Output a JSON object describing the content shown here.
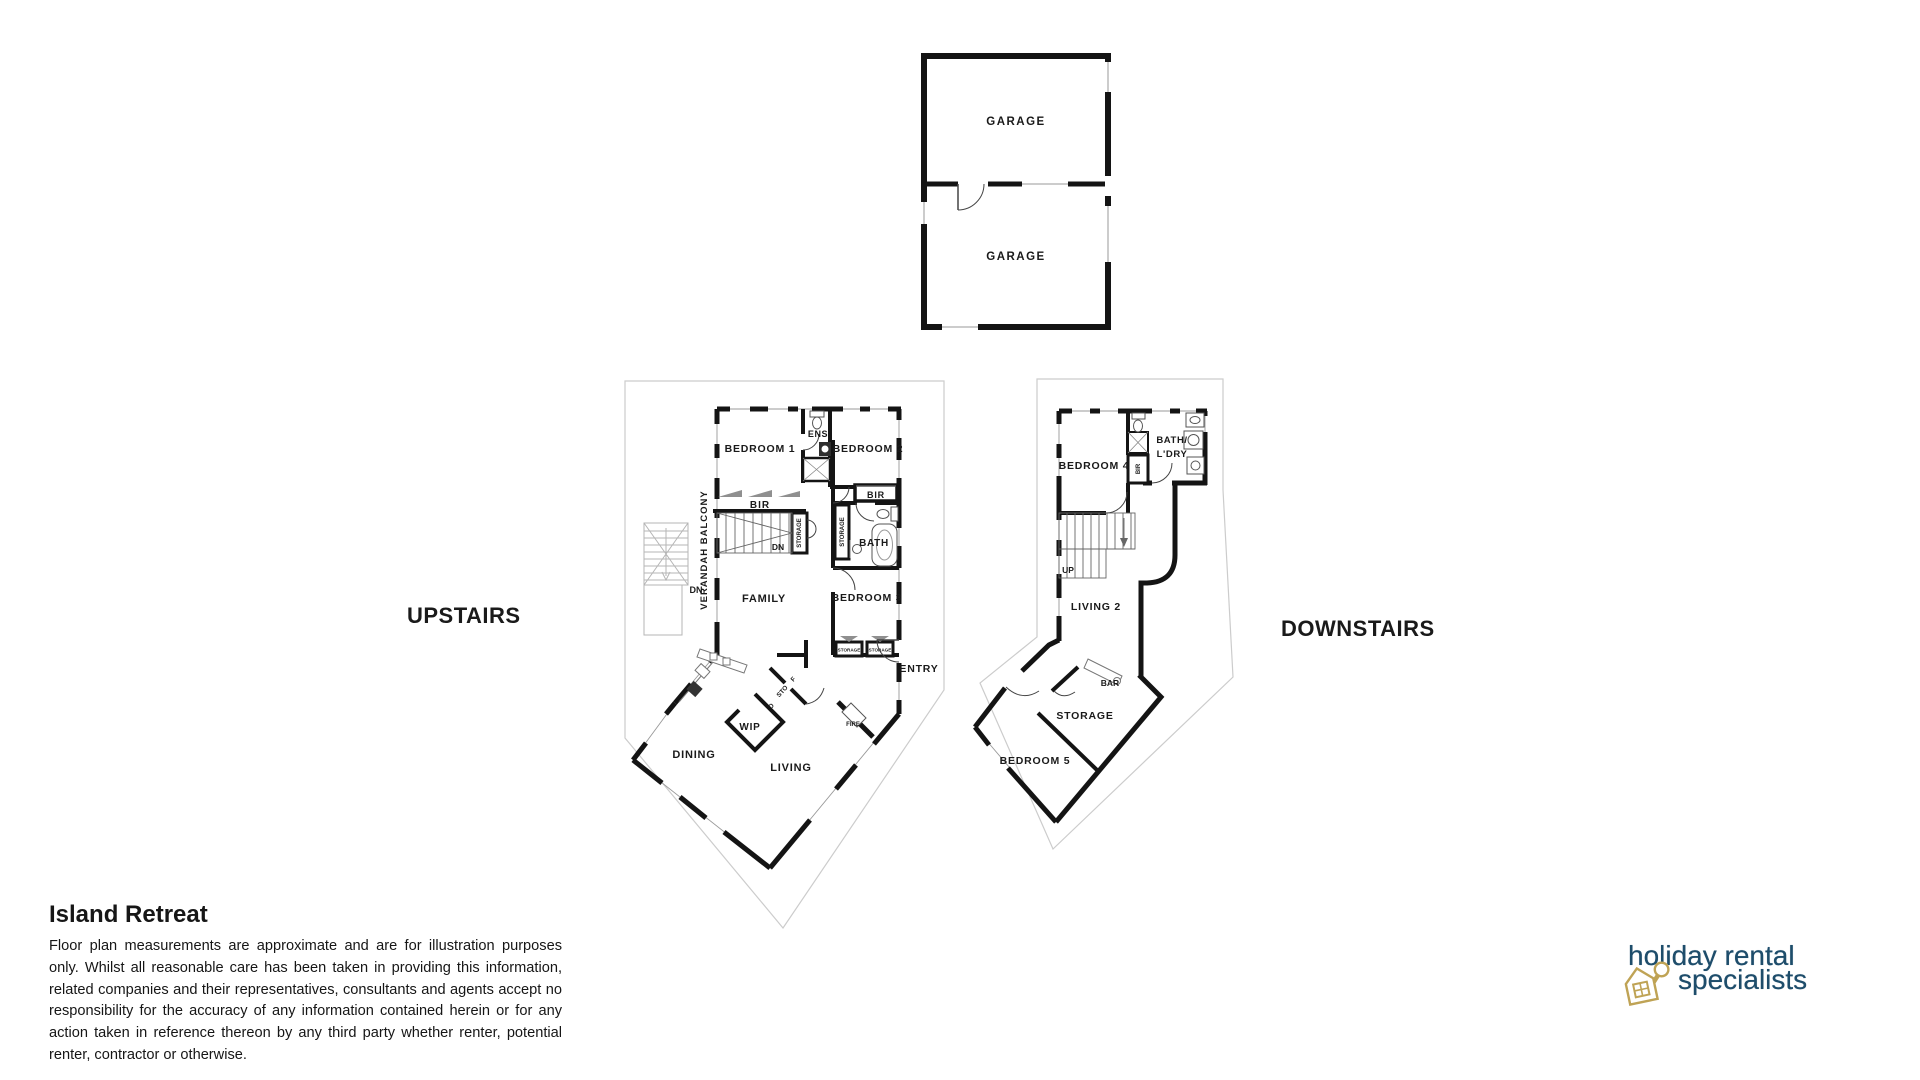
{
  "sections": {
    "upstairs_label": "UPSTAIRS",
    "downstairs_label": "DOWNSTAIRS"
  },
  "garage_plan": {
    "rooms": [
      "GARAGE",
      "GARAGE"
    ]
  },
  "upstairs_plan": {
    "bedroom1": "BEDROOM 1",
    "ens": "ENS",
    "bedroom2": "BEDROOM 2",
    "bir_bedroom1": "BIR",
    "bir_bedroom2": "BIR",
    "stairs_storage": "STORAGE",
    "stairs_dn": "DN",
    "bath": "BATH",
    "bath_storage": "STORAGE",
    "bedroom3": "BEDROOM 3",
    "bedroom3_storage_left": "STORAGE",
    "bedroom3_storage_right": "STORAGE",
    "family": "FAMILY",
    "entry": "ENTRY",
    "verandah_balcony": "VERANDAH BALCONY",
    "verandah_dn": "DN",
    "wip": "WIP",
    "dining": "DINING",
    "living": "LIVING",
    "fire": "FIRE",
    "cupboard_o": "O",
    "cupboard_sto": "STO",
    "cupboard_f": "F"
  },
  "downstairs_plan": {
    "bedroom4": "BEDROOM 4",
    "bath_ldry_line1": "BATH/",
    "bath_ldry_line2": "L'DRY",
    "bir": "BIR",
    "stairs_up": "UP",
    "living2": "LIVING 2",
    "bar": "BAR",
    "storage": "STORAGE",
    "bedroom5": "BEDROOM 5"
  },
  "footer": {
    "title": "Island Retreat",
    "disclaimer": "Floor plan measurements are approximate and are for illustration purposes only. Whilst all reasonable care has been taken in providing this information, related companies and their representatives, consultants and agents accept no responsibility for the accuracy of any information contained herein or for any action taken in reference thereon by any third party whether renter, potential renter, contractor or otherwise."
  },
  "logo": {
    "line1": "holiday rental",
    "line2": "specialists",
    "icon": "house-keyring-key-icon",
    "text_color": "#1e4d6b",
    "icon_color": "#bfa355"
  },
  "colors": {
    "background": "#ffffff",
    "walls": "#141414",
    "thin_line": "#999999",
    "outline": "#cccccc",
    "label_text": "#1a1a1a"
  }
}
